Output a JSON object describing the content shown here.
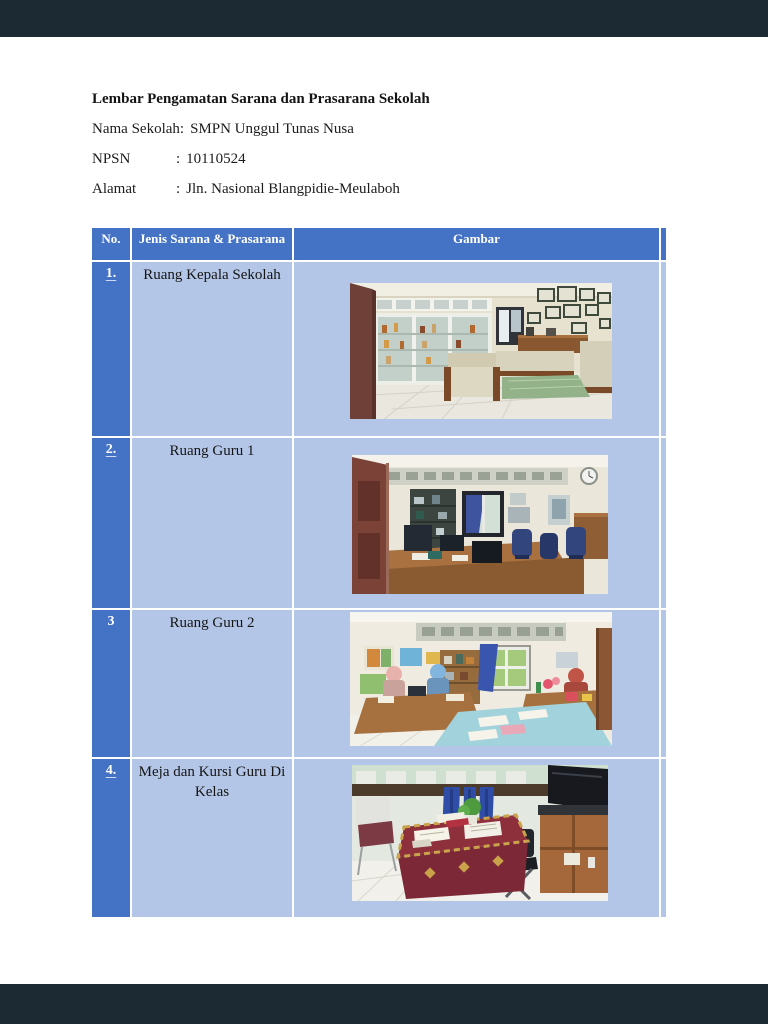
{
  "viewer": {
    "frame_bar_color": "#1c2b33",
    "page_color": "#ffffff"
  },
  "document": {
    "title": "Lembar Pengamatan Sarana dan Prasarana Sekolah",
    "info_lines": [
      {
        "label": "Nama Sekolah",
        "sep": ":",
        "value": "SMPN Unggul Tunas Nusa"
      },
      {
        "label": "NPSN",
        "sep": ":",
        "value": "10110524"
      },
      {
        "label": "Alamat",
        "sep": ":",
        "value": "Jln. Nasional Blangpidie-Meulaboh"
      }
    ],
    "table": {
      "columns": {
        "no": "No.",
        "jenis": "Jenis Sarana & Prasarana",
        "gambar": "Gambar"
      },
      "colors": {
        "header_bg": "#4472C4",
        "number_cell_bg": "#4472C4",
        "body_cell_bg": "#B4C6E7",
        "grid_line": "#FFFFFF",
        "header_text": "#FFFFFF",
        "body_text": "#151515"
      },
      "rows": [
        {
          "no": "1.",
          "name": "Ruang Kepala Sekolah",
          "photo_alt": "Foto ruang kepala sekolah: lemari piala kaca, sofa tamu krem berkayu coklat, meja bertaplak hijau, dan piagam berbingkai di dinding"
        },
        {
          "no": "2.",
          "name": "Ruang Guru 1",
          "photo_alt": "Foto ruang guru: pintu merah marun, rak gelap, jendela bergorden biru, meja kerja kayu dengan komputer dan kursi biru, jam dinding"
        },
        {
          "no": "3",
          "name": "Ruang Guru 2",
          "photo_alt": "Foto ruang guru: guru berjilbab duduk di meja kayu, poster warna-warni, jendela bergorden biru, meja depan berkain biru muda"
        },
        {
          "no": "4.",
          "name": "Meja dan Kursi Guru Di Kelas",
          "photo_alt": "Foto meja guru bertaplak batik merah dengan buku dan tanaman kecil, kursi lipat hitam, lemari kayu dan televisi, dinding hijau mint"
        }
      ]
    }
  }
}
